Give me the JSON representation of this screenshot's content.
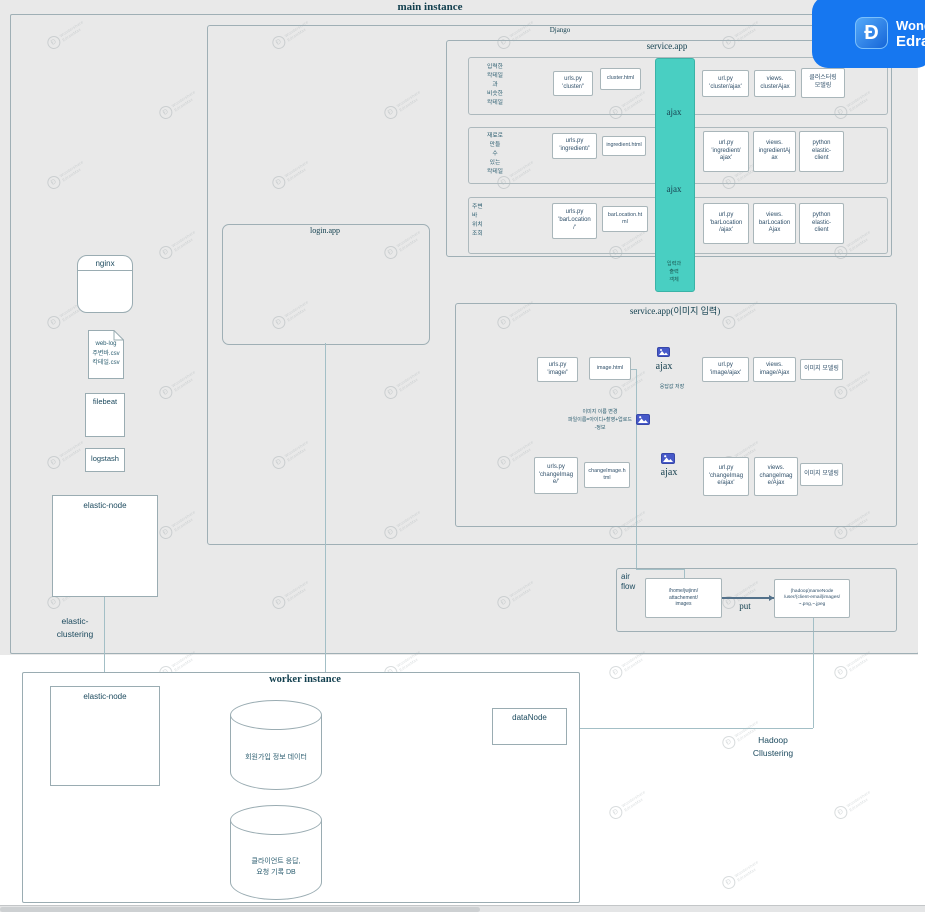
{
  "watermark": {
    "glyph": "Ɖ",
    "line1": "Wondershare",
    "line2": "EdrawMax"
  },
  "badge": {
    "glyph": "Ð",
    "line1": "Wondershare",
    "line2": "EdrawMax",
    "bg": "#1677f0"
  },
  "titles": {
    "main": "main instance",
    "django": "Django",
    "service": "service.app",
    "login": "login.app",
    "image": "service.app(이미지 입력)",
    "worker": "worker instance"
  },
  "service_rows": [
    {
      "note": "입력한\n칵테일\n과\n비슷한\n칵테일",
      "boxes": [
        "urls.py\n'cluster/'",
        "cluster.html",
        "url.py\n'cluster/ajax'",
        "views.\nclusterAjax",
        "클러스터링\n모델링"
      ]
    },
    {
      "note": "재료로\n만들\n수\n있는\n칵테일",
      "boxes": [
        "urls.py\n'ingredient/'",
        "ingredient.html",
        "url.py\n'ingredient/\najax'",
        "views.\ningredientAj\nax",
        "python\nelastic-\nclient"
      ]
    },
    {
      "note": "주변\n바\n위치\n조회",
      "boxes": [
        "urls.py\n'barLocation\n/'",
        "barLocation.ht\nml",
        "url.py\n'barLocation\n/ajax'",
        "views.\nbarLocation\nAjax",
        "python\nelastic-\nclient"
      ]
    }
  ],
  "ajax_bar": {
    "top": "ajax",
    "mid": "ajax",
    "note": "입력과\n출력\n객체"
  },
  "image_app": {
    "ajax1": "ajax",
    "ajax2": "ajax",
    "save_note": "응답값 저장",
    "middle_note": "이미지 이름 변경\n파일이름=아이디+촬영+업로드\n-정보",
    "row1": [
      "urls.py\n'image/'",
      "image.html",
      "url.py\n'image/ajax'",
      "views.\nimage/Ajax",
      "이미지 모델링"
    ],
    "row2": [
      "urls.py\n'changeImag\ne/'",
      "changeImage.h\ntml",
      "url.py\n'changeImag\ne/ajax'",
      "views.\nchangeImag\ne/Ajax",
      "이미지 모델링"
    ]
  },
  "airflow": {
    "label": "air\nflow",
    "src": "/home/jwjinn/\nattachement/\nimages",
    "action": "put",
    "dst": "(hadoop)nameNode\n/user/(client-email)images/\n~.png,~.jpeg"
  },
  "left": {
    "nginx": "nginx",
    "weblog": "web-log\n주변바.csv\n칵테일.csv",
    "filebeat": "filebeat",
    "logstash": "logstash",
    "elastic_node": "elastic-node",
    "clustering": "elastic-\nclustering"
  },
  "worker": {
    "elastic_node": "elastic-node",
    "db1": "회원가입 정보 데이터",
    "db2": "클라이언트 응답,\n요청 기록 DB",
    "datanode": "dataNode",
    "hadoop": "Hadoop\nCllustering"
  }
}
